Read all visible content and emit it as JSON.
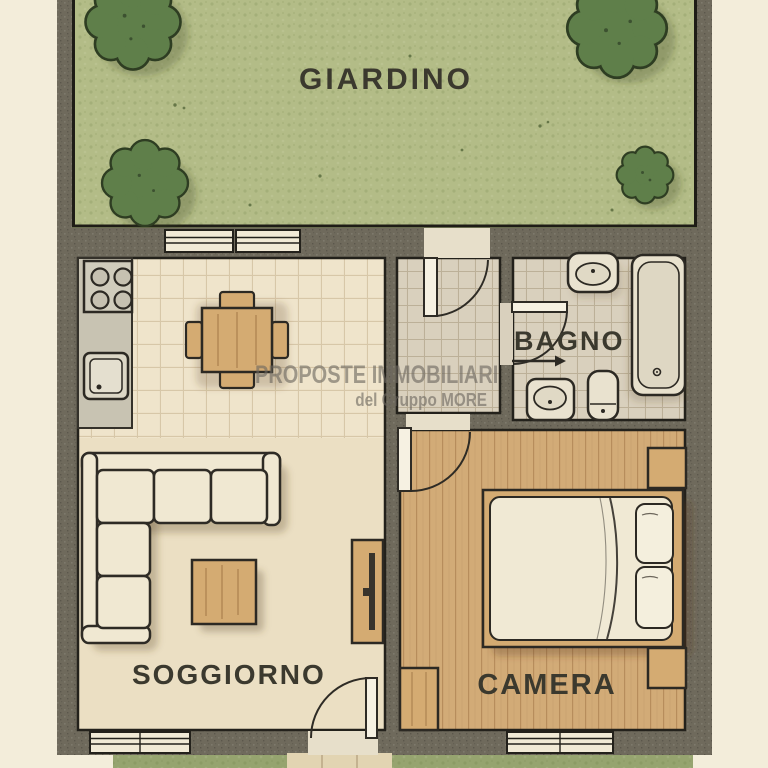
{
  "rooms": {
    "giardino": {
      "label": "GIARDINO"
    },
    "soggiorno": {
      "label": "SOGGIORNO"
    },
    "camera": {
      "label": "CAMERA"
    },
    "bagno": {
      "label": "BAGNO"
    }
  },
  "watermark": {
    "line1": "PROPOSTE IMMOBILIARI",
    "line2": "del Gruppo MORE"
  },
  "fixtures": {
    "garden": [
      "tree",
      "tree",
      "tree",
      "tree",
      "lawn"
    ],
    "kitchen": [
      "stove",
      "counter",
      "sink",
      "dining-table",
      "four-chairs",
      "double-window"
    ],
    "living": [
      "corner-sofa",
      "coffee-table",
      "tv-cabinet",
      "window",
      "front-door"
    ],
    "bathroom": [
      "washbasin",
      "bathtub",
      "bidet",
      "toilet",
      "entrance-arrow",
      "door"
    ],
    "bedroom": [
      "double-bed",
      "pillow",
      "pillow",
      "nightstand",
      "nightstand",
      "wardrobe",
      "window",
      "door"
    ],
    "hall": [
      "entrance-door"
    ]
  },
  "colors": {
    "background": "#f3edda",
    "wall": "#6f6a5c",
    "outline": "#27241d",
    "garden_green": "#b3bc87",
    "tree_green": "#5f7f4a",
    "tree_outline": "#2e3d22",
    "kitchen_floor": "#efe4cb",
    "living_floor": "#ebdfc3",
    "hall_floor": "#d9d0bd",
    "bedroom_floor": "#d2ab77",
    "wood_furniture": "#d4ab72",
    "cream_furniture": "#f0e8d2",
    "counter": "#c8c3b2",
    "label_text": "#3b392e",
    "grass_strip": "#96a46f"
  }
}
